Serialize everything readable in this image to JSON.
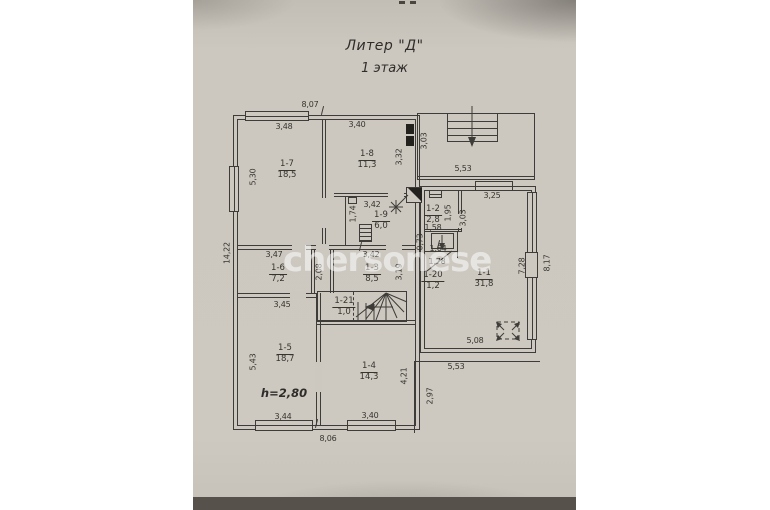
{
  "photo": {
    "title_line1": "Литер \"Д\"",
    "title_line2": "1 этаж",
    "watermark": "chersonese"
  },
  "plan": {
    "height_note": "h=2,80",
    "rooms": [
      {
        "id": "1-7",
        "area": "18,5",
        "x": 287,
        "y": 160
      },
      {
        "id": "1-8",
        "area": "11,3",
        "x": 367,
        "y": 150
      },
      {
        "id": "1-9",
        "area": "6,0",
        "x": 381,
        "y": 211
      },
      {
        "id": "1-2",
        "area": "2,8",
        "x": 433,
        "y": 205
      },
      {
        "id": "1-6",
        "area": "7,2",
        "x": 278,
        "y": 264
      },
      {
        "id": "1-3",
        "area": "8,5",
        "x": 372,
        "y": 264
      },
      {
        "id": "1-20",
        "area": "1,2",
        "x": 433,
        "y": 271
      },
      {
        "id": "1-1",
        "area": "31,8",
        "x": 484,
        "y": 269
      },
      {
        "id": "1-21",
        "area": "1,0",
        "x": 344,
        "y": 297
      },
      {
        "id": "1-5",
        "area": "18,7",
        "x": 285,
        "y": 344
      },
      {
        "id": "1-4",
        "area": "14,3",
        "x": 369,
        "y": 362
      }
    ],
    "dims_h": [
      {
        "text": "8,07",
        "x": 310,
        "y": 100
      },
      {
        "text": "3,48",
        "x": 284,
        "y": 122
      },
      {
        "text": "3,40",
        "x": 357,
        "y": 120
      },
      {
        "text": "3,42",
        "x": 372,
        "y": 200
      },
      {
        "text": "1,58",
        "x": 433,
        "y": 223
      },
      {
        "text": "3,25",
        "x": 492,
        "y": 191
      },
      {
        "text": "5,53",
        "x": 463,
        "y": 164
      },
      {
        "text": "3,47",
        "x": 274,
        "y": 250
      },
      {
        "text": "3,42",
        "x": 371,
        "y": 250
      },
      {
        "text": "1,64",
        "x": 438,
        "y": 244
      },
      {
        "text": "1,78",
        "x": 437,
        "y": 257
      },
      {
        "text": "3,45",
        "x": 282,
        "y": 300
      },
      {
        "text": "5,08",
        "x": 475,
        "y": 336
      },
      {
        "text": "5,53",
        "x": 456,
        "y": 362
      },
      {
        "text": "3,44",
        "x": 283,
        "y": 412
      },
      {
        "text": "3,40",
        "x": 370,
        "y": 411
      },
      {
        "text": "8,06",
        "x": 328,
        "y": 434
      }
    ],
    "dims_v": [
      {
        "text": "5,30",
        "x": 253,
        "y": 177
      },
      {
        "text": "14,22",
        "x": 227,
        "y": 253
      },
      {
        "text": "5,43",
        "x": 253,
        "y": 362
      },
      {
        "text": "3,32",
        "x": 399,
        "y": 157
      },
      {
        "text": "3,03",
        "x": 424,
        "y": 141
      },
      {
        "text": "1,74",
        "x": 353,
        "y": 214
      },
      {
        "text": "2,08",
        "x": 319,
        "y": 272
      },
      {
        "text": "3,19",
        "x": 399,
        "y": 272
      },
      {
        "text": "1,95",
        "x": 448,
        "y": 213
      },
      {
        "text": "3,03",
        "x": 463,
        "y": 218
      },
      {
        "text": "0,73",
        "x": 420,
        "y": 242
      },
      {
        "text": "4,21",
        "x": 404,
        "y": 376
      },
      {
        "text": "2,97",
        "x": 430,
        "y": 396
      },
      {
        "text": "7,28",
        "x": 522,
        "y": 266
      },
      {
        "text": "8,17",
        "x": 547,
        "y": 263
      }
    ]
  }
}
